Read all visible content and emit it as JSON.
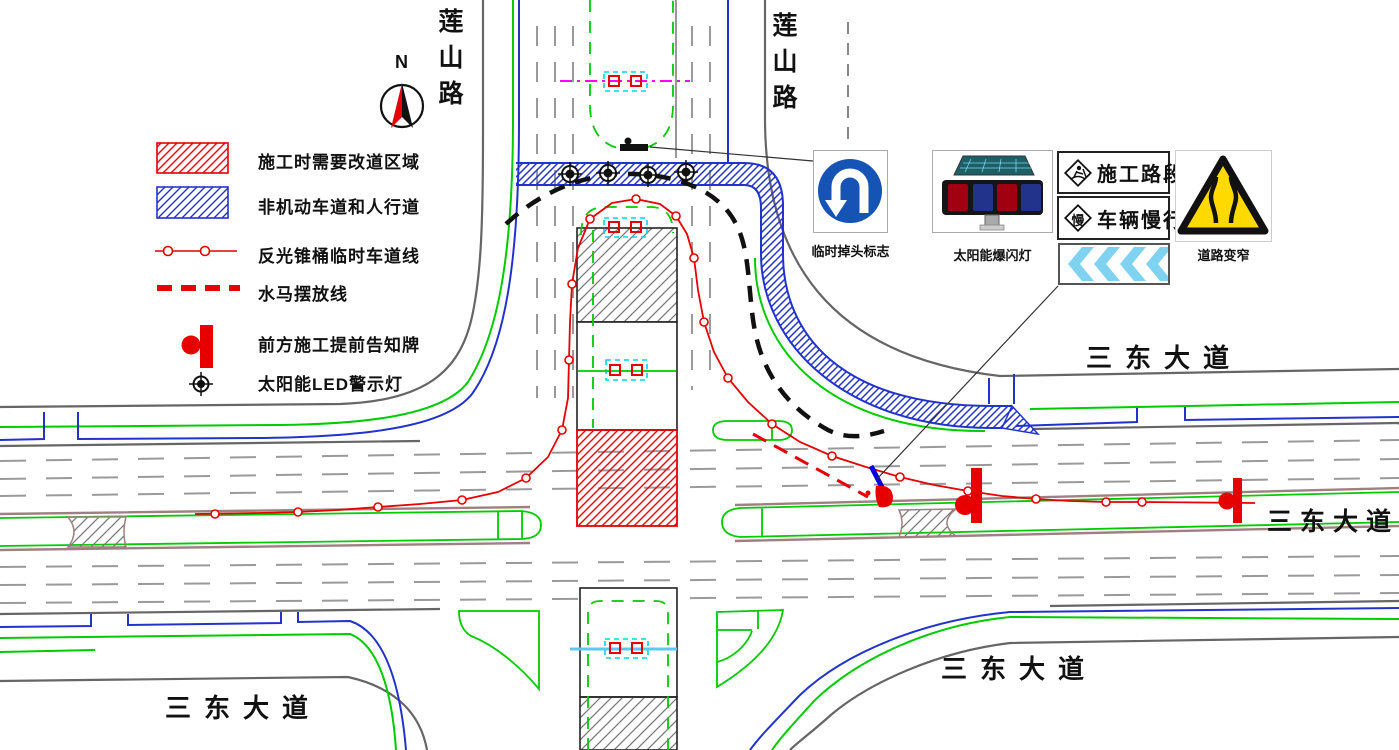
{
  "compass": {
    "north": "N"
  },
  "roads": {
    "lianshan_west": "莲山路",
    "lianshan_east": "莲山路",
    "sandong_northeast": "三东大道",
    "sandong_east": "三东大道",
    "sandong_southeast": "三东大道",
    "sandong_southwest": "三东大道"
  },
  "legend": {
    "items": [
      {
        "symbol": "construction-detour-area",
        "label": "施工时需要改道区域"
      },
      {
        "symbol": "non-motorized-and-pedestrian-way",
        "label": "非机动车道和人行道"
      },
      {
        "symbol": "reflective-cone-temporary-lane-line",
        "label": "反光锥桶临时车道线"
      },
      {
        "symbol": "water-barrier-placement-line",
        "label": "水马摆放线"
      },
      {
        "symbol": "advance-construction-notice-sign",
        "label": "前方施工提前告知牌"
      },
      {
        "symbol": "solar-led-warning-light",
        "label": "太阳能LED警示灯"
      }
    ]
  },
  "signs": {
    "uturn": {
      "caption": "临时掉头标志"
    },
    "solar_strobe": {
      "caption": "太阳能爆闪灯"
    },
    "construction_section": {
      "text": "施工路段"
    },
    "slow_down": {
      "diamond": "慢",
      "text": "车辆慢行"
    },
    "road_narrows": {
      "caption": "道路变窄"
    }
  },
  "colors": {
    "cone_red": "#e60000",
    "lane_green": "#00cc00",
    "nonmotor_blue": "#2233cc",
    "sign_blue": "#1553b5",
    "chevron_blue": "#7fd2f0",
    "warning_yellow": "#ffd900",
    "detector_magenta": "#ff00ff",
    "detector_cyan": "#00d5e5",
    "detector_sky_blue": "#5bc8f5"
  }
}
